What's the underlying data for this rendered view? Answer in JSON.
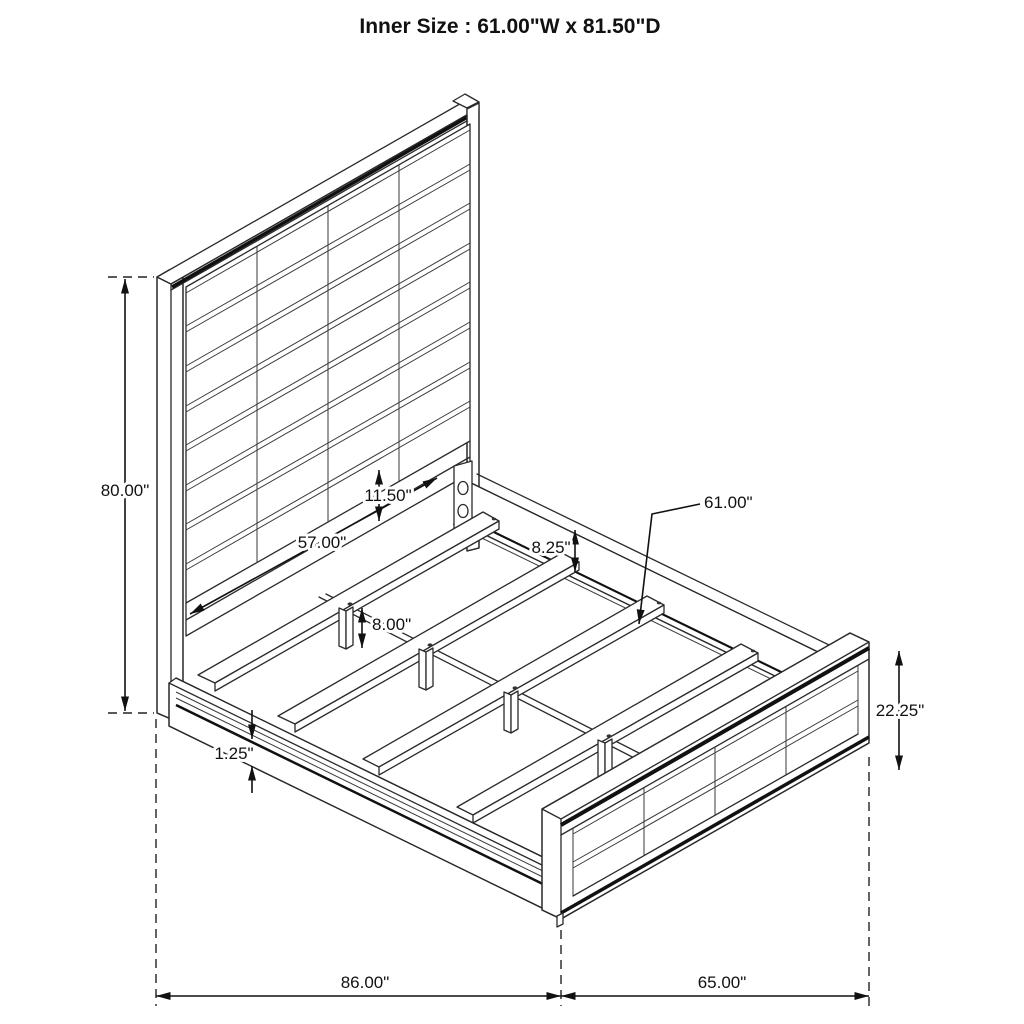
{
  "title": "Inner Size : 61.00\"W x 81.50\"D",
  "dims": {
    "headboard_height": "80.00\"",
    "inner_rail_span": "57.00\"",
    "headboard_panel_gap": "11.50\"",
    "side_rail_width": "8.25\"",
    "slat_length": "61.00\"",
    "support_leg_height": "8.00\"",
    "rail_lip_thickness": "1.25\"",
    "footboard_height": "22.25\"",
    "overall_depth": "86.00\"",
    "overall_width": "65.00\""
  }
}
